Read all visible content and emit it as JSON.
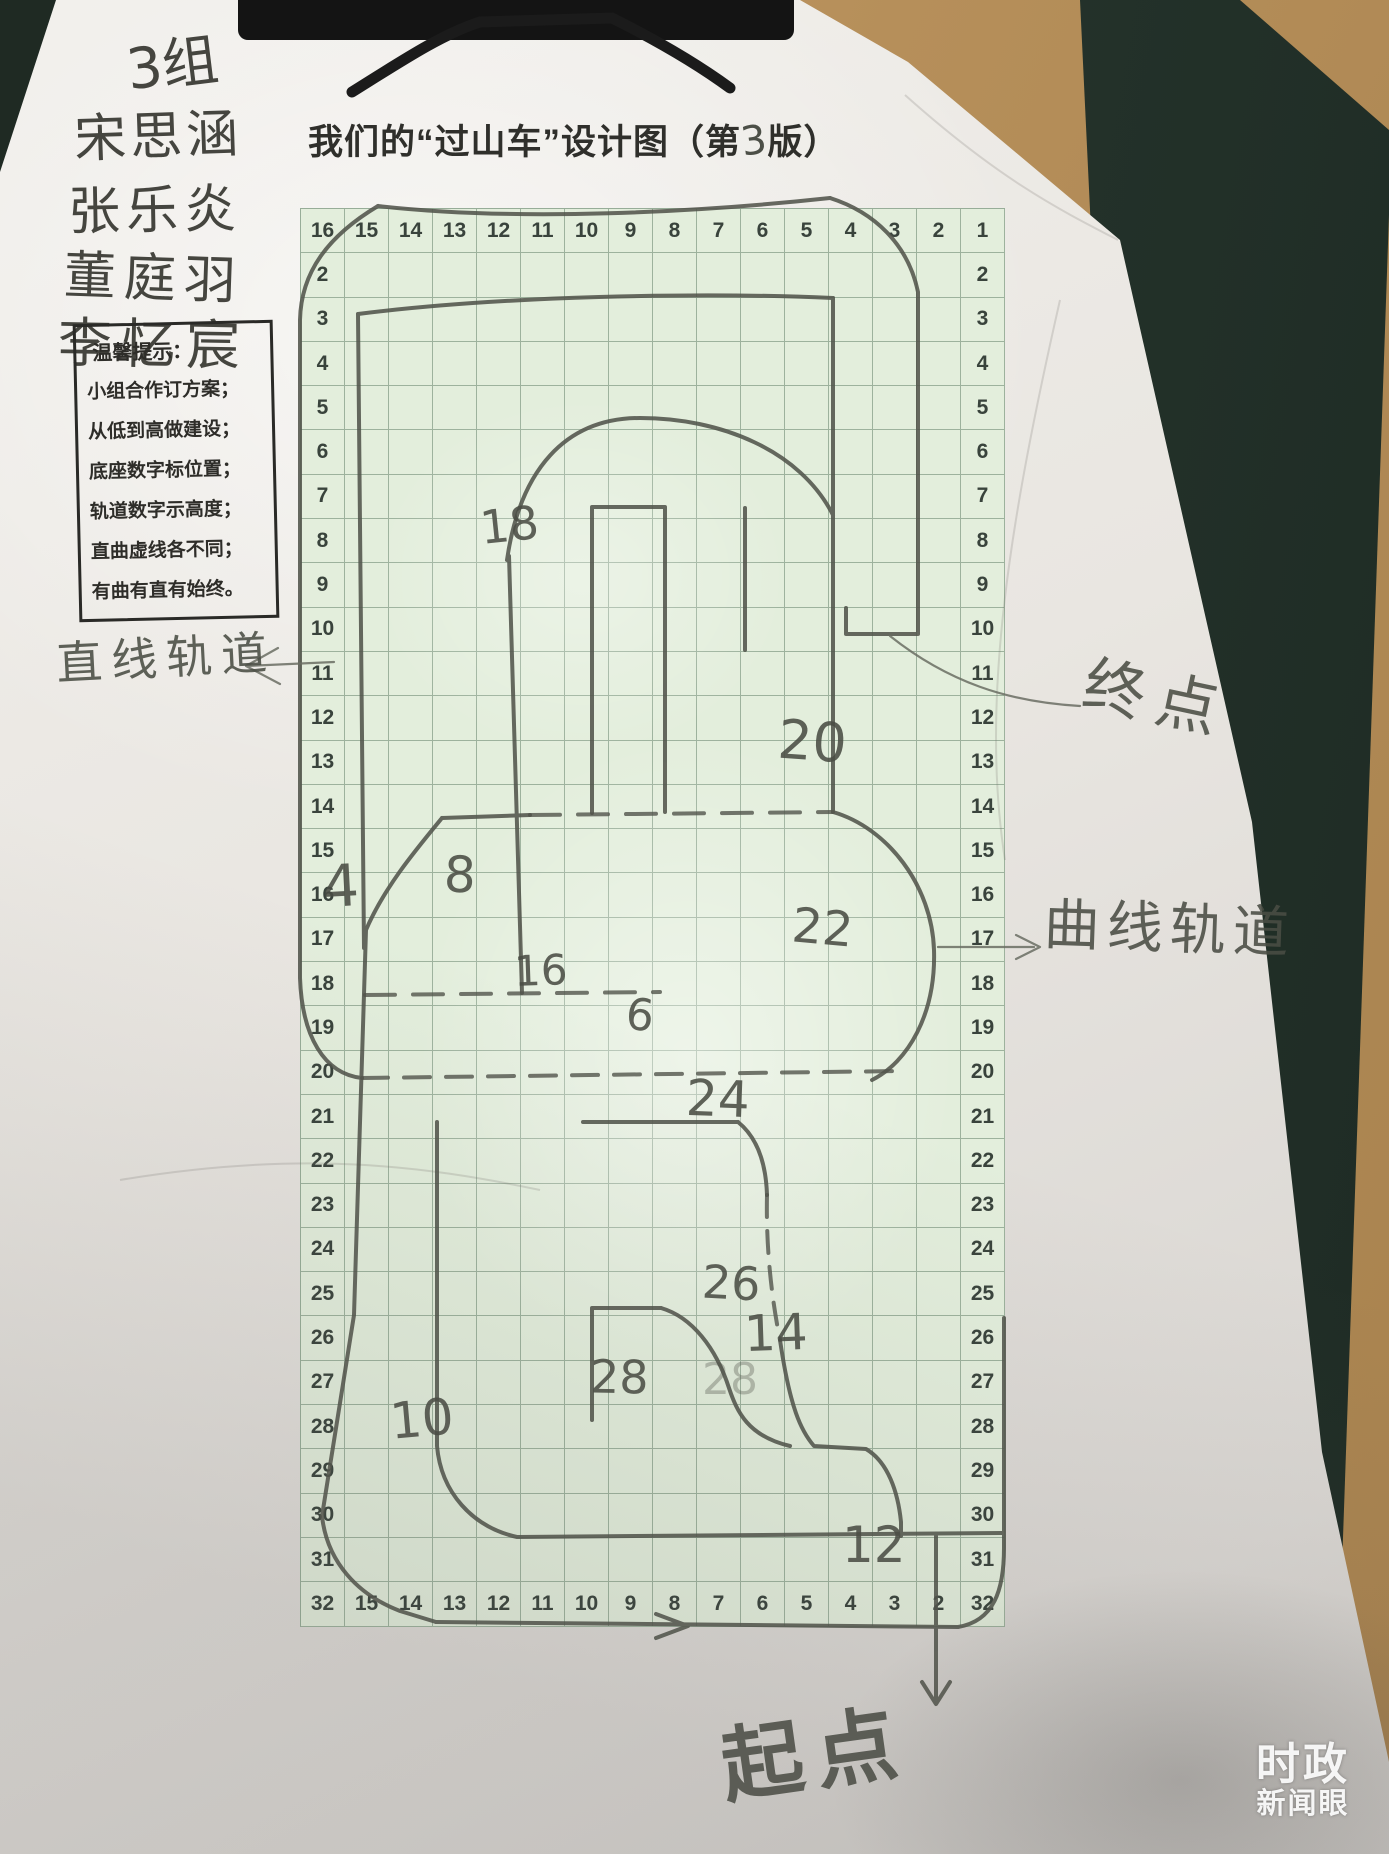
{
  "page": {
    "title_prefix": "我们的“过山车”设计图（第",
    "title_version": "3",
    "title_suffix": "版）"
  },
  "names": {
    "group_label": "3组",
    "members": [
      "宋思涵",
      "张乐炎",
      "董庭羽",
      "李忆宸"
    ]
  },
  "tips": {
    "heading": "温馨提示：",
    "lines": [
      "小组合作订方案；",
      "从低到高做建设；",
      "底座数字标位置；",
      "轨道数字示高度；",
      "直曲虚线各不同；",
      "有曲有直有始终。"
    ]
  },
  "grid": {
    "top_row": [
      "16",
      "15",
      "14",
      "13",
      "12",
      "11",
      "10",
      "9",
      "8",
      "7",
      "6",
      "5",
      "4",
      "3",
      "2",
      "1"
    ],
    "bottom_row": [
      "32",
      "15",
      "14",
      "13",
      "12",
      "11",
      "10",
      "9",
      "8",
      "7",
      "6",
      "5",
      "4",
      "3",
      "2",
      "32"
    ],
    "left_rows": [
      "2",
      "3",
      "4",
      "5",
      "6",
      "7",
      "8",
      "9",
      "10",
      "11",
      "12",
      "13",
      "14",
      "15",
      "16",
      "17",
      "18",
      "19",
      "20",
      "21",
      "22",
      "23",
      "24",
      "25",
      "26",
      "27",
      "28",
      "29",
      "30",
      "31"
    ],
    "right_rows": [
      "2",
      "3",
      "4",
      "5",
      "6",
      "7",
      "8",
      "9",
      "10",
      "11",
      "12",
      "13",
      "14",
      "15",
      "16",
      "17",
      "18",
      "19",
      "20",
      "21",
      "22",
      "23",
      "24",
      "25",
      "26",
      "27",
      "28",
      "29",
      "30",
      "31"
    ]
  },
  "track_numbers": [
    {
      "v": "18",
      "x": 480,
      "y": 498,
      "s": 46,
      "r": -6
    },
    {
      "v": "4",
      "x": 322,
      "y": 852,
      "s": 58,
      "r": -3
    },
    {
      "v": "8",
      "x": 444,
      "y": 846,
      "s": 50,
      "r": 2
    },
    {
      "v": "20",
      "x": 778,
      "y": 710,
      "s": 54,
      "r": 4
    },
    {
      "v": "22",
      "x": 792,
      "y": 900,
      "s": 48,
      "r": 5
    },
    {
      "v": "16",
      "x": 514,
      "y": 946,
      "s": 42,
      "r": -2
    },
    {
      "v": "6",
      "x": 626,
      "y": 990,
      "s": 44,
      "r": 6
    },
    {
      "v": "24",
      "x": 686,
      "y": 1070,
      "s": 50,
      "r": 2
    },
    {
      "v": "26",
      "x": 702,
      "y": 1256,
      "s": 46,
      "r": 3
    },
    {
      "v": "14",
      "x": 744,
      "y": 1304,
      "s": 50,
      "r": -2
    },
    {
      "v": "28",
      "x": 590,
      "y": 1350,
      "s": 46,
      "r": 1
    },
    {
      "v": "28",
      "x": 702,
      "y": 1354,
      "s": 44,
      "r": 0,
      "faint": true
    },
    {
      "v": "10",
      "x": 390,
      "y": 1390,
      "s": 50,
      "r": -5
    },
    {
      "v": "12",
      "x": 842,
      "y": 1516,
      "s": 50,
      "r": 0
    }
  ],
  "annotations": {
    "straight_track": "直线轨道",
    "end_point": "终点",
    "curved_track": "曲线轨道",
    "start_point": "起点"
  },
  "watermark": {
    "line1": "时政",
    "line2": "新闻眼"
  },
  "colors": {
    "grid_green": "#e3eedc",
    "grid_line": "#64826a",
    "pencil": "#51544b",
    "paper": "#eae7e1",
    "wood": "#b8925d",
    "clipboard": "#26352d",
    "watermark_text": "#ffffff"
  }
}
